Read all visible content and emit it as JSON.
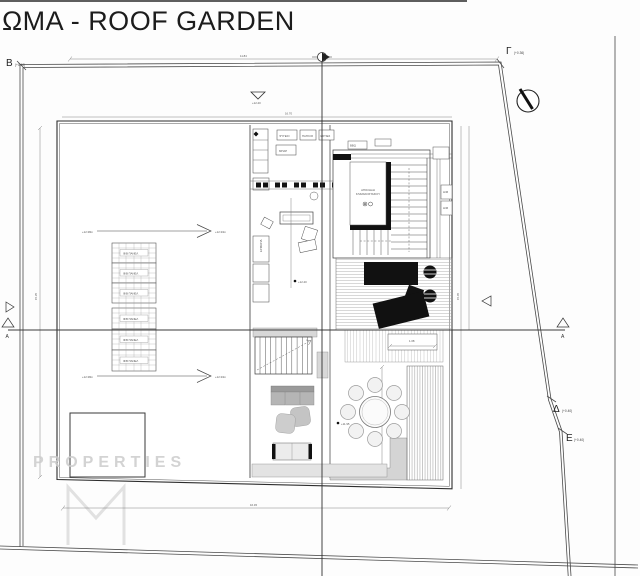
{
  "title": "ΩΜΑ - ROOF GARDEN",
  "watermark": "PROPERTIES",
  "markers": {
    "b": {
      "name": "Β",
      "elev": "(+0.40)"
    },
    "gamma": {
      "name": "Γ",
      "elev": "(+0.36)"
    },
    "delta": {
      "name": "Δ",
      "elev": "(+0.40)"
    },
    "epsilon": {
      "name": "Ε",
      "elev": "(+0.40)"
    },
    "section_a": "Α"
  },
  "icons": {
    "north": "north-arrow-compass",
    "section_cut": "section-cut-flag",
    "level": "nabla-level-symbol"
  },
  "levels": {
    "top_nabla": "+12.40",
    "kitchen_spot": "+12.40",
    "lounge_spot": "+11.95"
  },
  "slopes": {
    "from": "+12.38m",
    "to": "+12.33m"
  },
  "pv": {
    "label": "Φ/Β ΠΑΝΕΛ"
  },
  "kitchen": {
    "box1": "ΨΥΓΕΙΟ",
    "box2": "ΠΑΓΚΟΣ",
    "box3": "ΕΣΤΙΕΣ",
    "box4": "ΜΠΑΡ",
    "cab": "ΕΡΜΑΡΙΑ"
  },
  "stair": {
    "label1": "ΑΠΟΛΗΞΗ",
    "label2": "ΚΛΙΜΑΚΟΣΤΑΣΙΟΥ"
  },
  "equip": {
    "box1": "Η/Μ",
    "box2": "Η/Μ",
    "side1": "BBQ"
  },
  "dims": {
    "top": "11.84",
    "building_top": "16.70",
    "bottom": "16.45",
    "left": "15.35",
    "right": "15.45",
    "deck": "1.08"
  },
  "colors": {
    "line": "#333333",
    "fill_gray": "#d6d6d6",
    "watermark": "#cccccc",
    "black_furniture": "#111111"
  }
}
